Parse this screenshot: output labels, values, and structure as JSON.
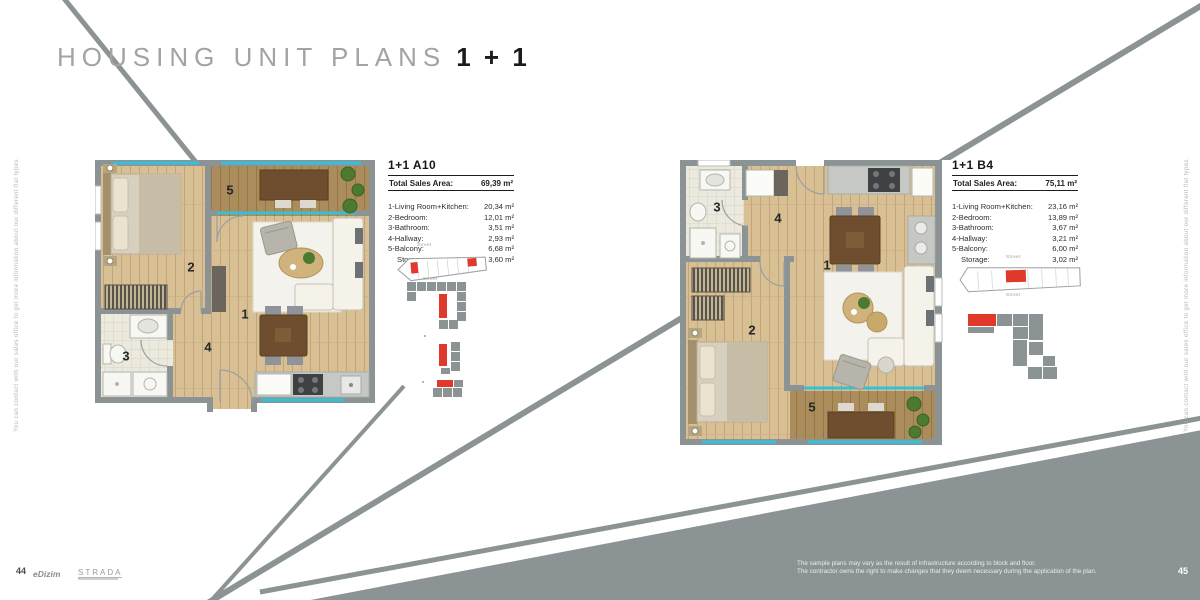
{
  "page": {
    "title": "HOUSING UNIT PLANS",
    "title_suffix": "1 + 1",
    "page_number_left": "44",
    "page_number_right": "45",
    "logo_edizim": "eDizim",
    "logo_strada": "STRADA",
    "side_note": "You can contact with our sales office to get more information about our different flat types.",
    "disclaimer_line1": "The sample plans may vary as the result of infrastructure according to block and floor.",
    "disclaimer_line2": "The contractor owns the right to make changes that they deem necessary during the application of the plan."
  },
  "colors": {
    "accent_red": "#e0392b",
    "band_gray": "#8c9394",
    "window_blue": "#35bfd9",
    "wood_light": "#d8c094",
    "wood_dark": "#ab8c5c"
  },
  "plans": [
    {
      "name": "1+1 A10",
      "total_label": "Total Sales Area:",
      "total_value": "69,39 m²",
      "rows": [
        {
          "label": "1-Living Room+Kitchen:",
          "value": "20,34 m²"
        },
        {
          "label": "2-Bedroom:",
          "value": "12,01 m²"
        },
        {
          "label": "3-Bathroom:",
          "value": "3,51 m²"
        },
        {
          "label": "4-Hallway:",
          "value": "2,93 m²"
        },
        {
          "label": "5-Balcony:",
          "value": "6,68 m²"
        },
        {
          "label": "Storage:",
          "value": "3,60 m²"
        }
      ],
      "room_numbers": [
        "1",
        "2",
        "3",
        "4",
        "5"
      ],
      "street_label": "Street"
    },
    {
      "name": "1+1 B4",
      "total_label": "Total Sales Area:",
      "total_value": "75,11 m²",
      "rows": [
        {
          "label": "1-Living Room+Kitchen:",
          "value": "23,16 m²"
        },
        {
          "label": "2-Bedroom:",
          "value": "13,89 m²"
        },
        {
          "label": "3-Bathroom:",
          "value": "3,67 m²"
        },
        {
          "label": "4-Hallway:",
          "value": "3,21 m²"
        },
        {
          "label": "5-Balcony:",
          "value": "6,00 m²"
        },
        {
          "label": "Storage:",
          "value": "3,02 m²"
        }
      ],
      "room_numbers": [
        "1",
        "2",
        "3",
        "4",
        "5"
      ],
      "street_label": "Street"
    }
  ]
}
